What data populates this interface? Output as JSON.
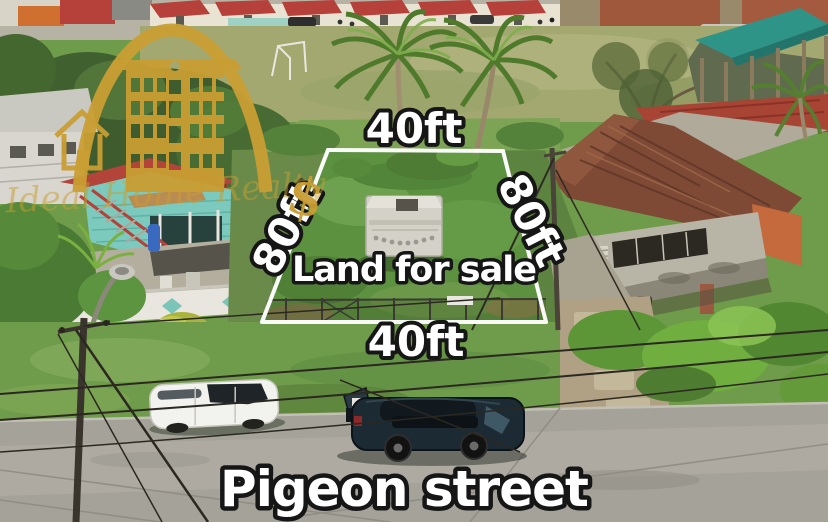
{
  "photo_type": "aerial-drone-real-estate-listing",
  "plot": {
    "label": "Land for sale",
    "top_width": "40ft",
    "bottom_width": "40ft",
    "left_depth": "80ft",
    "right_depth": "80ft"
  },
  "street": {
    "name": "Pigeon street"
  },
  "watermark": {
    "brand_script": "Ideal Home Realty",
    "dollar": "$"
  },
  "colors": {
    "logo_gold": "#c99e33",
    "label_fill": "#ffffff",
    "label_outline": "#161616",
    "boundary_line": "#ffffff",
    "plot_grass": "#5c9140",
    "road_gray": "#a5a29a",
    "left_house_teal": "#7cc9bd",
    "left_house_roof": "#b2443a",
    "right_house_rust": "#7e4a36",
    "pavilion_teal": "#2f9488",
    "suv_dark": "#1c2b33",
    "wagon_white": "#f2f2ee"
  }
}
